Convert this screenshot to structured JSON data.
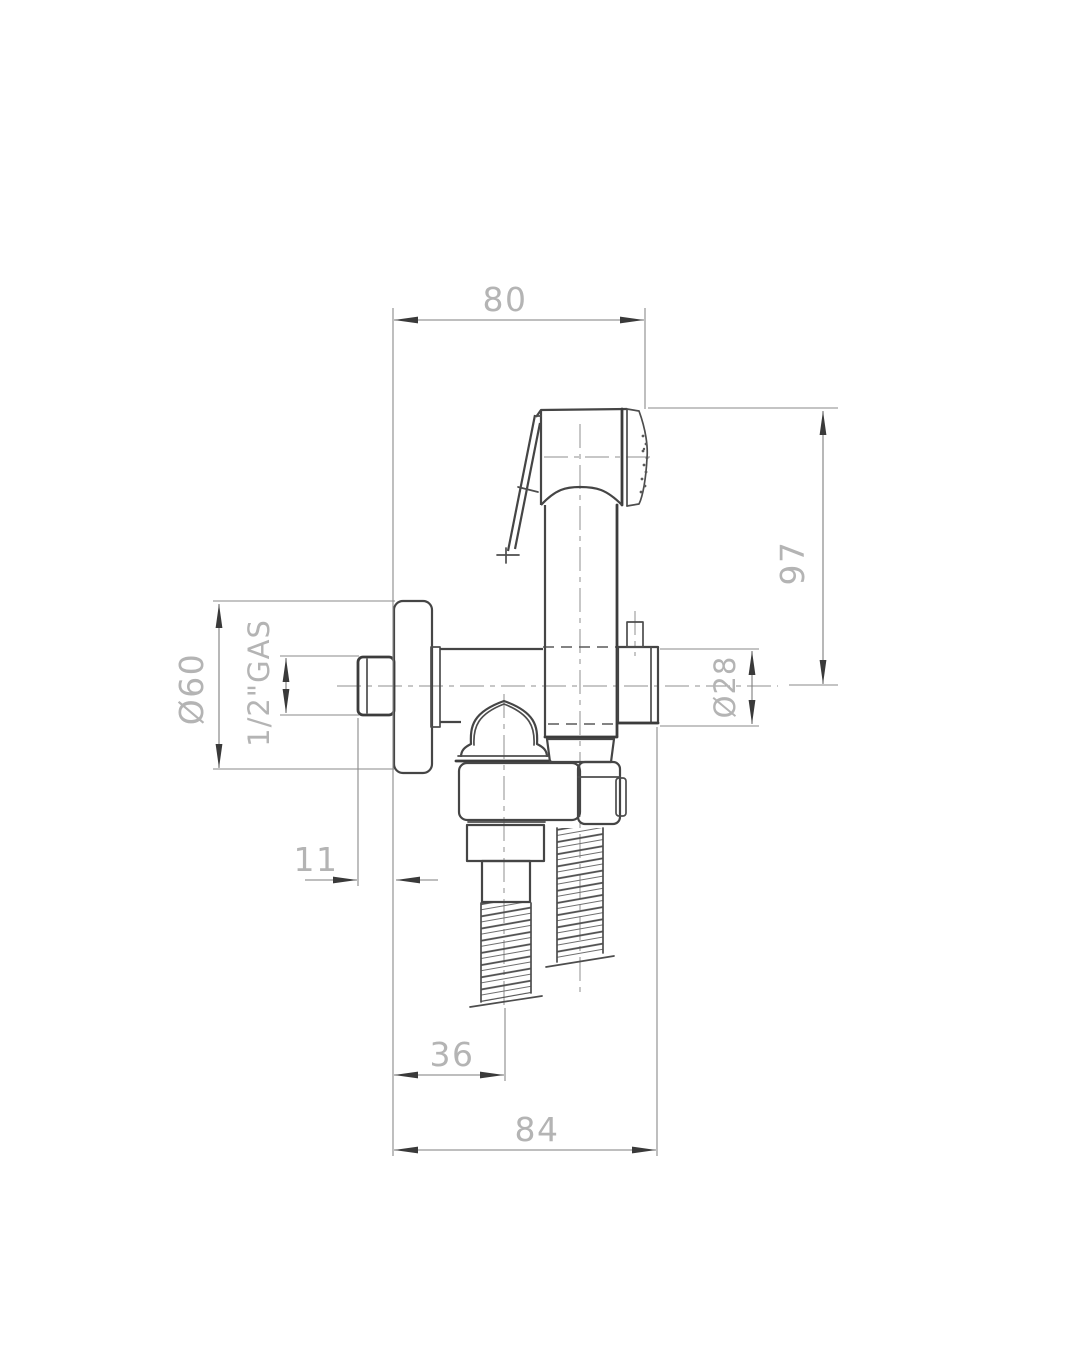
{
  "drawing": {
    "type": "technical-dimension-drawing",
    "subject": "wall-mounted hygienic hand sprayer set with shut-off valve, side view",
    "background_color": "#ffffff",
    "outline_color": "#4d4d4d",
    "dimension_line_color": "#7d7d7d",
    "dimension_text_color": "#b4b4b4",
    "dims": {
      "top_width": "80",
      "right_height": "97",
      "flange_diameter": "Ø60",
      "thread_size": "1/2\"GAS",
      "body_diameter": "Ø28",
      "stub_projection": "11",
      "outlet_offset": "36",
      "bottom_width": "84"
    }
  }
}
